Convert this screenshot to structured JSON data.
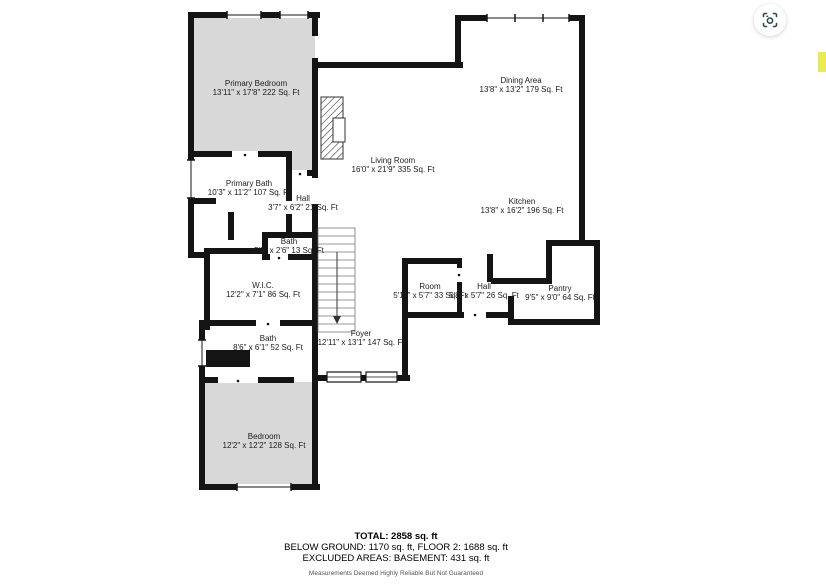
{
  "floorplan": {
    "colors": {
      "wall": "#141414",
      "room_fill": "#d8d8d8",
      "thin_line": "#777777"
    },
    "rooms": [
      {
        "name": "Primary Bedroom",
        "dims": "13'11\" x 17'8\" 222 Sq. Ft"
      },
      {
        "name": "Dining Area",
        "dims": "13'8\" x 13'2\" 179 Sq. Ft"
      },
      {
        "name": "Living Room",
        "dims": "16'0\" x 21'9\" 335 Sq. Ft"
      },
      {
        "name": "Kitchen",
        "dims": "13'8\" x 16'2\" 196 Sq. Ft"
      },
      {
        "name": "Primary Bath",
        "dims": "10'3\" x 11'2\" 107 Sq. Ft"
      },
      {
        "name": "Hall",
        "dims": "3'7\" x 6'2\" 21 Sq. Ft"
      },
      {
        "name": "Bath",
        "dims": "5'3\" x 2'6\" 13 Sq. Ft"
      },
      {
        "name": "W.I.C.",
        "dims": "12'2\" x 7'1\" 86 Sq. Ft"
      },
      {
        "name": "Room",
        "dims": "5'11\" x 5'7\" 33 Sq. Ft"
      },
      {
        "name": "Hall",
        "dims": "5'8\" x 5'7\" 26 Sq. Ft"
      },
      {
        "name": "Pantry",
        "dims": "9'5\" x 9'0\" 64 Sq. Ft"
      },
      {
        "name": "Foyer",
        "dims": "12'11\" x 13'1\" 147 Sq. Ft"
      },
      {
        "name": "Bath",
        "dims": "8'6\" x 6'1\" 52 Sq. Ft"
      },
      {
        "name": "Bedroom",
        "dims": "12'2\" x 12'2\" 128 Sq. Ft"
      }
    ],
    "features": [
      "stairs",
      "fireplace",
      "windows",
      "doors"
    ]
  },
  "summary": {
    "total": "TOTAL: 2858 sq. ft",
    "line2": "BELOW GROUND: 1170 sq. ft, FLOOR 2: 1688 sq. ft",
    "line3": "EXCLUDED AREAS: BASEMENT: 431 sq. ft",
    "disclaimer": "Measurements Deemed Highly Reliable But Not Guaranteed"
  },
  "toolbar": {
    "camera_button_icon": "camera-viewfinder-icon",
    "camera_icon_color": "#2b4a59"
  },
  "markers": {
    "highlight_color": "#e9ec4e"
  }
}
